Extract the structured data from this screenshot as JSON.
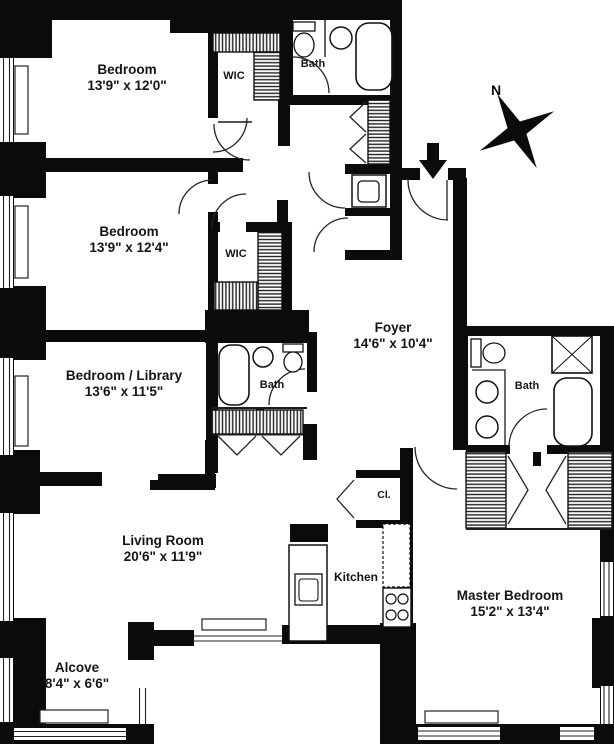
{
  "compass": {
    "label": "N"
  },
  "icons": {
    "compass": "compass-rose",
    "entry": "entry-arrow"
  },
  "colors": {
    "wall": "#0b0b0b",
    "background": "#ffffff",
    "line": "#1c1c1c"
  },
  "rooms": {
    "bedroom_top": {
      "name": "Bedroom",
      "dims": "13'9\" x 12'0\""
    },
    "bedroom_mid": {
      "name": "Bedroom",
      "dims": "13'9\" x 12'4\""
    },
    "bedroom_library": {
      "name": "Bedroom / Library",
      "dims": "13'6\" x 11'5\""
    },
    "living_room": {
      "name": "Living Room",
      "dims": "20'6\" x 11'9\""
    },
    "alcove": {
      "name": "Alcove",
      "dims": "8'4\" x 6'6\""
    },
    "foyer": {
      "name": "Foyer",
      "dims": "14'6\" x 10'4\""
    },
    "master_bedroom": {
      "name": "Master Bedroom",
      "dims": "15'2\" x 13'4\""
    },
    "kitchen": {
      "name": "Kitchen"
    },
    "wic_top": {
      "name": "WIC"
    },
    "wic_mid": {
      "name": "WIC"
    },
    "bath_top": {
      "name": "Bath"
    },
    "bath_mid": {
      "name": "Bath"
    },
    "bath_master": {
      "name": "Bath"
    },
    "closet": {
      "name": "Cl."
    }
  }
}
